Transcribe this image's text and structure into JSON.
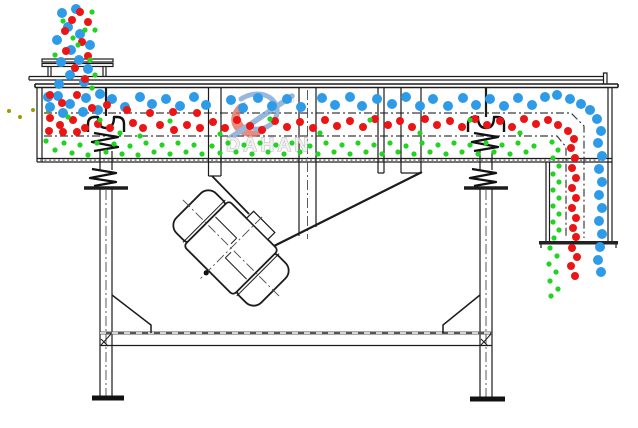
{
  "watermark": {
    "brand": "DAHAN",
    "registered_mark": "®"
  },
  "colors": {
    "line": "#1c1c1c",
    "particle_blue": "#2e9be8",
    "particle_red": "#ec1515",
    "particle_green": "#21d421",
    "particle_olive": "#9a9a00",
    "watermark_gray": "#a0a0a0",
    "watermark_fill": "#eeeeee",
    "logo_red": "#de6b5c",
    "logo_blue": "#7ba3d4"
  },
  "particles": {
    "blue": {
      "radius": 5,
      "points": [
        [
          62,
          13
        ],
        [
          76,
          9
        ],
        [
          68,
          27
        ],
        [
          57,
          40
        ],
        [
          80,
          34
        ],
        [
          71,
          50
        ],
        [
          61,
          62
        ],
        [
          79,
          60
        ],
        [
          70,
          75
        ],
        [
          59,
          84
        ],
        [
          84,
          82
        ],
        [
          90,
          45
        ],
        [
          88,
          69
        ],
        [
          48,
          97
        ],
        [
          58,
          96
        ],
        [
          70,
          104
        ],
        [
          86,
          98
        ],
        [
          100,
          94
        ],
        [
          63,
          113
        ],
        [
          83,
          112
        ],
        [
          98,
          110
        ],
        [
          50,
          107
        ],
        [
          112,
          99
        ],
        [
          125,
          107
        ],
        [
          140,
          97
        ],
        [
          152,
          104
        ],
        [
          166,
          99
        ],
        [
          180,
          106
        ],
        [
          194,
          97
        ],
        [
          206,
          105
        ],
        [
          231,
          100
        ],
        [
          243,
          108
        ],
        [
          258,
          98
        ],
        [
          272,
          106
        ],
        [
          287,
          99
        ],
        [
          301,
          107
        ],
        [
          322,
          98
        ],
        [
          335,
          105
        ],
        [
          350,
          97
        ],
        [
          362,
          106
        ],
        [
          377,
          99
        ],
        [
          392,
          104
        ],
        [
          406,
          97
        ],
        [
          420,
          106
        ],
        [
          433,
          99
        ],
        [
          448,
          106
        ],
        [
          463,
          98
        ],
        [
          476,
          105
        ],
        [
          490,
          99
        ],
        [
          504,
          106
        ],
        [
          518,
          98
        ],
        [
          532,
          105
        ],
        [
          545,
          97
        ],
        [
          557,
          95
        ],
        [
          570,
          99
        ],
        [
          581,
          104
        ],
        [
          590,
          110
        ],
        [
          597,
          119
        ],
        [
          601,
          131
        ],
        [
          598,
          143
        ],
        [
          602,
          156
        ],
        [
          599,
          169
        ],
        [
          602,
          182
        ],
        [
          599,
          195
        ],
        [
          602,
          208
        ],
        [
          599,
          221
        ],
        [
          602,
          234
        ],
        [
          600,
          247
        ],
        [
          598,
          260
        ],
        [
          601,
          272
        ]
      ]
    },
    "red": {
      "radius": 4,
      "points": [
        [
          80,
          12
        ],
        [
          88,
          22
        ],
        [
          72,
          20
        ],
        [
          65,
          31
        ],
        [
          82,
          42
        ],
        [
          66,
          51
        ],
        [
          88,
          56
        ],
        [
          75,
          68
        ],
        [
          85,
          79
        ],
        [
          50,
          95
        ],
        [
          62,
          103
        ],
        [
          77,
          95
        ],
        [
          92,
          108
        ],
        [
          107,
          105
        ],
        [
          50,
          118
        ],
        [
          60,
          125
        ],
        [
          73,
          120
        ],
        [
          85,
          128
        ],
        [
          49,
          131
        ],
        [
          63,
          132
        ],
        [
          77,
          132
        ],
        [
          98,
          124
        ],
        [
          110,
          128
        ],
        [
          127,
          110
        ],
        [
          133,
          123
        ],
        [
          143,
          128
        ],
        [
          150,
          113
        ],
        [
          160,
          125
        ],
        [
          173,
          112
        ],
        [
          174,
          130
        ],
        [
          187,
          125
        ],
        [
          197,
          113
        ],
        [
          200,
          128
        ],
        [
          213,
          122
        ],
        [
          225,
          128
        ],
        [
          237,
          120
        ],
        [
          250,
          126
        ],
        [
          262,
          130
        ],
        [
          275,
          121
        ],
        [
          287,
          127
        ],
        [
          300,
          122
        ],
        [
          313,
          128
        ],
        [
          325,
          120
        ],
        [
          337,
          126
        ],
        [
          350,
          121
        ],
        [
          363,
          127
        ],
        [
          375,
          119
        ],
        [
          388,
          125
        ],
        [
          400,
          121
        ],
        [
          412,
          127
        ],
        [
          425,
          119
        ],
        [
          437,
          125
        ],
        [
          450,
          121
        ],
        [
          462,
          127
        ],
        [
          475,
          119
        ],
        [
          487,
          125
        ],
        [
          500,
          121
        ],
        [
          512,
          127
        ],
        [
          524,
          119
        ],
        [
          536,
          124
        ],
        [
          548,
          120
        ],
        [
          558,
          125
        ],
        [
          568,
          131
        ],
        [
          574,
          139
        ],
        [
          571,
          148
        ],
        [
          575,
          158
        ],
        [
          572,
          168
        ],
        [
          576,
          178
        ],
        [
          572,
          188
        ],
        [
          576,
          198
        ],
        [
          572,
          208
        ],
        [
          576,
          218
        ],
        [
          573,
          228
        ],
        [
          576,
          237
        ],
        [
          572,
          248
        ],
        [
          577,
          257
        ],
        [
          571,
          266
        ],
        [
          575,
          276
        ]
      ]
    },
    "green": {
      "radius": 2.6,
      "points": [
        [
          92,
          12
        ],
        [
          95,
          30
        ],
        [
          90,
          60
        ],
        [
          95,
          75
        ],
        [
          85,
          30
        ],
        [
          78,
          45
        ],
        [
          92,
          88
        ],
        [
          55,
          55
        ],
        [
          63,
          21
        ],
        [
          73,
          38
        ],
        [
          68,
          117
        ],
        [
          120,
          133
        ],
        [
          170,
          121
        ],
        [
          220,
          134
        ],
        [
          270,
          119
        ],
        [
          320,
          133
        ],
        [
          370,
          120
        ],
        [
          420,
          133
        ],
        [
          470,
          120
        ],
        [
          520,
          133
        ],
        [
          100,
          120
        ],
        [
          140,
          136
        ],
        [
          46,
          141
        ],
        [
          55,
          150
        ],
        [
          64,
          143
        ],
        [
          72,
          153
        ],
        [
          80,
          145
        ],
        [
          88,
          155
        ],
        [
          97,
          143
        ],
        [
          106,
          152
        ],
        [
          114,
          144
        ],
        [
          122,
          154
        ],
        [
          130,
          146
        ],
        [
          138,
          155
        ],
        [
          146,
          143
        ],
        [
          154,
          152
        ],
        [
          162,
          145
        ],
        [
          170,
          154
        ],
        [
          178,
          143
        ],
        [
          186,
          152
        ],
        [
          194,
          145
        ],
        [
          202,
          154
        ],
        [
          212,
          146
        ],
        [
          220,
          153
        ],
        [
          228,
          143
        ],
        [
          236,
          152
        ],
        [
          244,
          145
        ],
        [
          252,
          154
        ],
        [
          260,
          143
        ],
        [
          268,
          152
        ],
        [
          276,
          145
        ],
        [
          284,
          154
        ],
        [
          292,
          143
        ],
        [
          300,
          152
        ],
        [
          310,
          146
        ],
        [
          318,
          154
        ],
        [
          326,
          143
        ],
        [
          334,
          152
        ],
        [
          342,
          145
        ],
        [
          350,
          154
        ],
        [
          358,
          143
        ],
        [
          366,
          152
        ],
        [
          374,
          145
        ],
        [
          382,
          154
        ],
        [
          390,
          143
        ],
        [
          398,
          152
        ],
        [
          406,
          146
        ],
        [
          414,
          154
        ],
        [
          422,
          143
        ],
        [
          430,
          152
        ],
        [
          438,
          145
        ],
        [
          446,
          154
        ],
        [
          454,
          143
        ],
        [
          462,
          152
        ],
        [
          470,
          145
        ],
        [
          478,
          154
        ],
        [
          486,
          143
        ],
        [
          494,
          152
        ],
        [
          502,
          145
        ],
        [
          510,
          154
        ],
        [
          518,
          143
        ],
        [
          526,
          152
        ],
        [
          534,
          146
        ],
        [
          552,
          142
        ],
        [
          558,
          150
        ],
        [
          553,
          158
        ],
        [
          559,
          166
        ],
        [
          553,
          174
        ],
        [
          559,
          182
        ],
        [
          553,
          190
        ],
        [
          559,
          198
        ],
        [
          553,
          206
        ],
        [
          559,
          214
        ],
        [
          553,
          222
        ],
        [
          559,
          230
        ],
        [
          554,
          238
        ],
        [
          550,
          248
        ],
        [
          557,
          256
        ],
        [
          549,
          264
        ],
        [
          556,
          272
        ],
        [
          550,
          281
        ],
        [
          558,
          289
        ],
        [
          551,
          296
        ]
      ]
    },
    "olive": {
      "radius": 2,
      "points": [
        [
          9,
          111
        ],
        [
          20,
          117
        ],
        [
          33,
          110
        ],
        [
          48,
          111
        ]
      ]
    }
  }
}
